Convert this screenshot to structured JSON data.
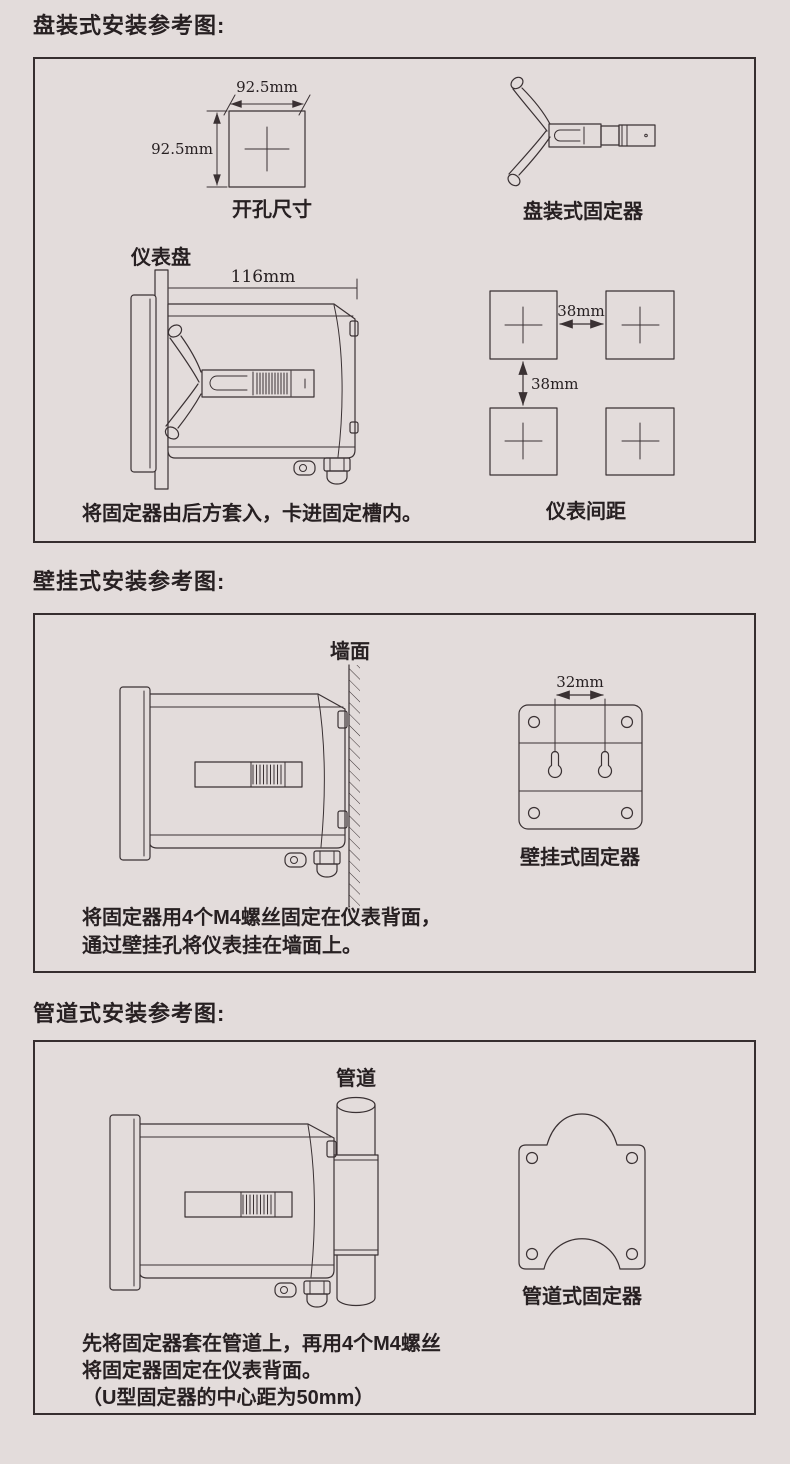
{
  "page": {
    "background_color": "#e3dcdb",
    "line_color": "#3a3133",
    "text_color": "#272022"
  },
  "sections": {
    "panel": {
      "title": "盘装式安装参考图:",
      "cutout": {
        "width_label": "92.5mm",
        "height_label": "92.5mm",
        "label": "开孔尺寸"
      },
      "fixer_label": "盘装式固定器",
      "side_view": {
        "panel_label": "仪表盘",
        "depth_label": "116mm"
      },
      "spacing": {
        "gap_horizontal": "38mm",
        "gap_vertical": "38mm",
        "label": "仪表间距"
      },
      "caption": "将固定器由后方套入，卡进固定槽内。"
    },
    "wall": {
      "title": "壁挂式安装参考图:",
      "wall_label": "墙面",
      "hole_pitch_label": "32mm",
      "fixer_label": "壁挂式固定器",
      "caption_lines": [
        "将固定器用4个M4螺丝固定在仪表背面，",
        "通过壁挂孔将仪表挂在墙面上。"
      ]
    },
    "pipe": {
      "title": "管道式安装参考图:",
      "pipe_label": "管道",
      "fixer_label": "管道式固定器",
      "caption_lines": [
        "先将固定器套在管道上，再用4个M4螺丝",
        "将固定器固定在仪表背面。",
        "（U型固定器的中心距为50mm）"
      ]
    }
  }
}
